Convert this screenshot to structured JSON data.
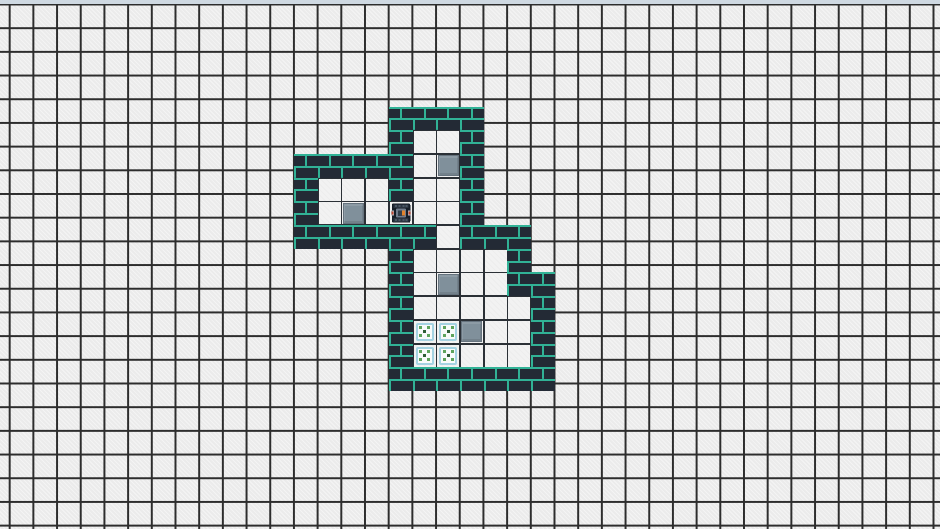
{
  "window": {
    "width": 940,
    "height": 529
  },
  "scene": {
    "kind": "sokoban-puzzle-game",
    "visible_text": "",
    "entity_counts": {
      "crates": 4,
      "targets": 4,
      "players": 1
    }
  },
  "background": {
    "grid_cell_size": 23.7,
    "grid_offset_x": 8.7,
    "grid_offset_y": 3.5,
    "top_strip_height": 3.5
  },
  "colors": {
    "background_tile": "#ebebeb",
    "grid_line": "#2d2d2d",
    "top_strip": "#cfd9e2",
    "wall_brick": "#232a35",
    "wall_mortar": "#31b296",
    "floor": "#f2f2f2",
    "floor_line": "#2b3036",
    "crate": "#80909b",
    "target_border": "#a5d3e2",
    "target_dot_green": "#5ea45c",
    "target_dot_dark": "#2e5f35",
    "player_body": "#161d27",
    "player_accent": "#e1832d"
  },
  "level": {
    "origin_x": 294,
    "origin_y": 106.5,
    "tile_size": 23.7,
    "cols": 11,
    "rows": 12,
    "legend": {
      "#": "wall",
      ".": "floor",
      "T": "target",
      "B": "crate",
      "@": "player",
      " ": "outside"
    },
    "map": [
      "    ####   ",
      "    #..#   ",
      "#####.B#   ",
      "#...#..#   ",
      "#.B.@..#   ",
      "######.### ",
      "    #....# ",
      "    #.B..##",
      "    #.....#",
      "    #TTB..#",
      "    #TT...#",
      "    #######"
    ],
    "entities": {
      "player": {
        "col": 4,
        "row": 4
      },
      "crates": [
        {
          "col": 6,
          "row": 2
        },
        {
          "col": 2,
          "row": 4
        },
        {
          "col": 6,
          "row": 7
        },
        {
          "col": 7,
          "row": 9
        }
      ],
      "targets": [
        {
          "col": 5,
          "row": 9
        },
        {
          "col": 6,
          "row": 9
        },
        {
          "col": 5,
          "row": 10
        },
        {
          "col": 6,
          "row": 10
        }
      ]
    }
  }
}
